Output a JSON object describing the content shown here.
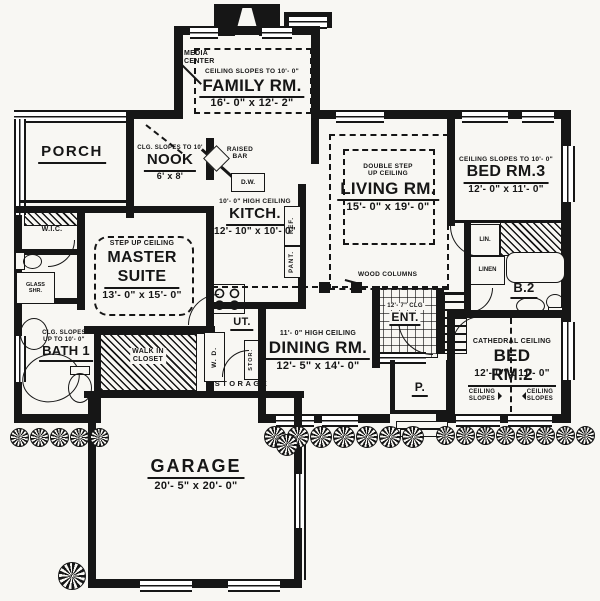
{
  "colors": {
    "ink": "#161616",
    "paper": "#f8f7f3"
  },
  "rooms": {
    "media_center": "MEDIA\nCENTER",
    "family": {
      "note": "CEILING SLOPES TO 10'- 0\"",
      "name": "FAMILY RM.",
      "dims": "16'- 0\" x 12'- 2\""
    },
    "porch": {
      "name": "PORCH"
    },
    "nook": {
      "note": "CLG. SLOPES TO 10'",
      "name": "NOOK",
      "dims": "6' x 8'"
    },
    "kitchen": {
      "raised_bar": "RAISED\nBAR",
      "dw": "D.W.",
      "note": "10'- 0\" HIGH CEILING",
      "name": "KITCH.",
      "dims": "12'- 10\" x 10'- 0\"",
      "ref": "REF.",
      "pant": "PANT."
    },
    "living": {
      "note": "DOUBLE STEP\nUP CEILING",
      "name": "LIVING RM.",
      "dims": "15'- 0\" x 19'- 0\""
    },
    "bed3": {
      "note": "CEILING SLOPES TO 10'- 0\"",
      "name": "BED RM.3",
      "dims": "12'- 0\" x 11'- 0\"",
      "lin": "LIN."
    },
    "master": {
      "note": "STEP UP CEILING",
      "name": "MASTER\nSUITE",
      "dims": "13'- 0\" x 15'- 0\""
    },
    "wic": "W.I.C.",
    "glass_shower": "GLASS\nSHR.",
    "bath1": {
      "note": "CLG. SLOPES\nUP TO 10'- 0\"",
      "name": "BATH 1"
    },
    "walkin_closet": "WALK IN\nCLOSET",
    "utility": {
      "name": "UT.",
      "wd": "W. D.",
      "stor": "STOR.",
      "storage": "STORAGE"
    },
    "dining": {
      "note": "11'- 0\" HIGH CEILING",
      "name": "DINING RM.",
      "dims": "12'- 5\" x 14'- 0\""
    },
    "entry": {
      "note": "12'- 7\" CLG",
      "name": "ENT.",
      "porch": "P."
    },
    "bed2": {
      "note": "CATHEDRAL CEILING",
      "name": "BED RM.2",
      "dims": "12'- 0\" x 11'- 0\"",
      "slope_left": "CEILING\nSLOPES",
      "slope_right": "CEILING\nSLOPES"
    },
    "b2": {
      "name": "B.2",
      "linen": "LINEN",
      "lin": "LIN."
    },
    "garage": {
      "name": "GARAGE",
      "dims": "20'- 5\" x 20'- 0\""
    }
  },
  "annotations": {
    "wood_columns": "WOOD COLUMNS"
  }
}
